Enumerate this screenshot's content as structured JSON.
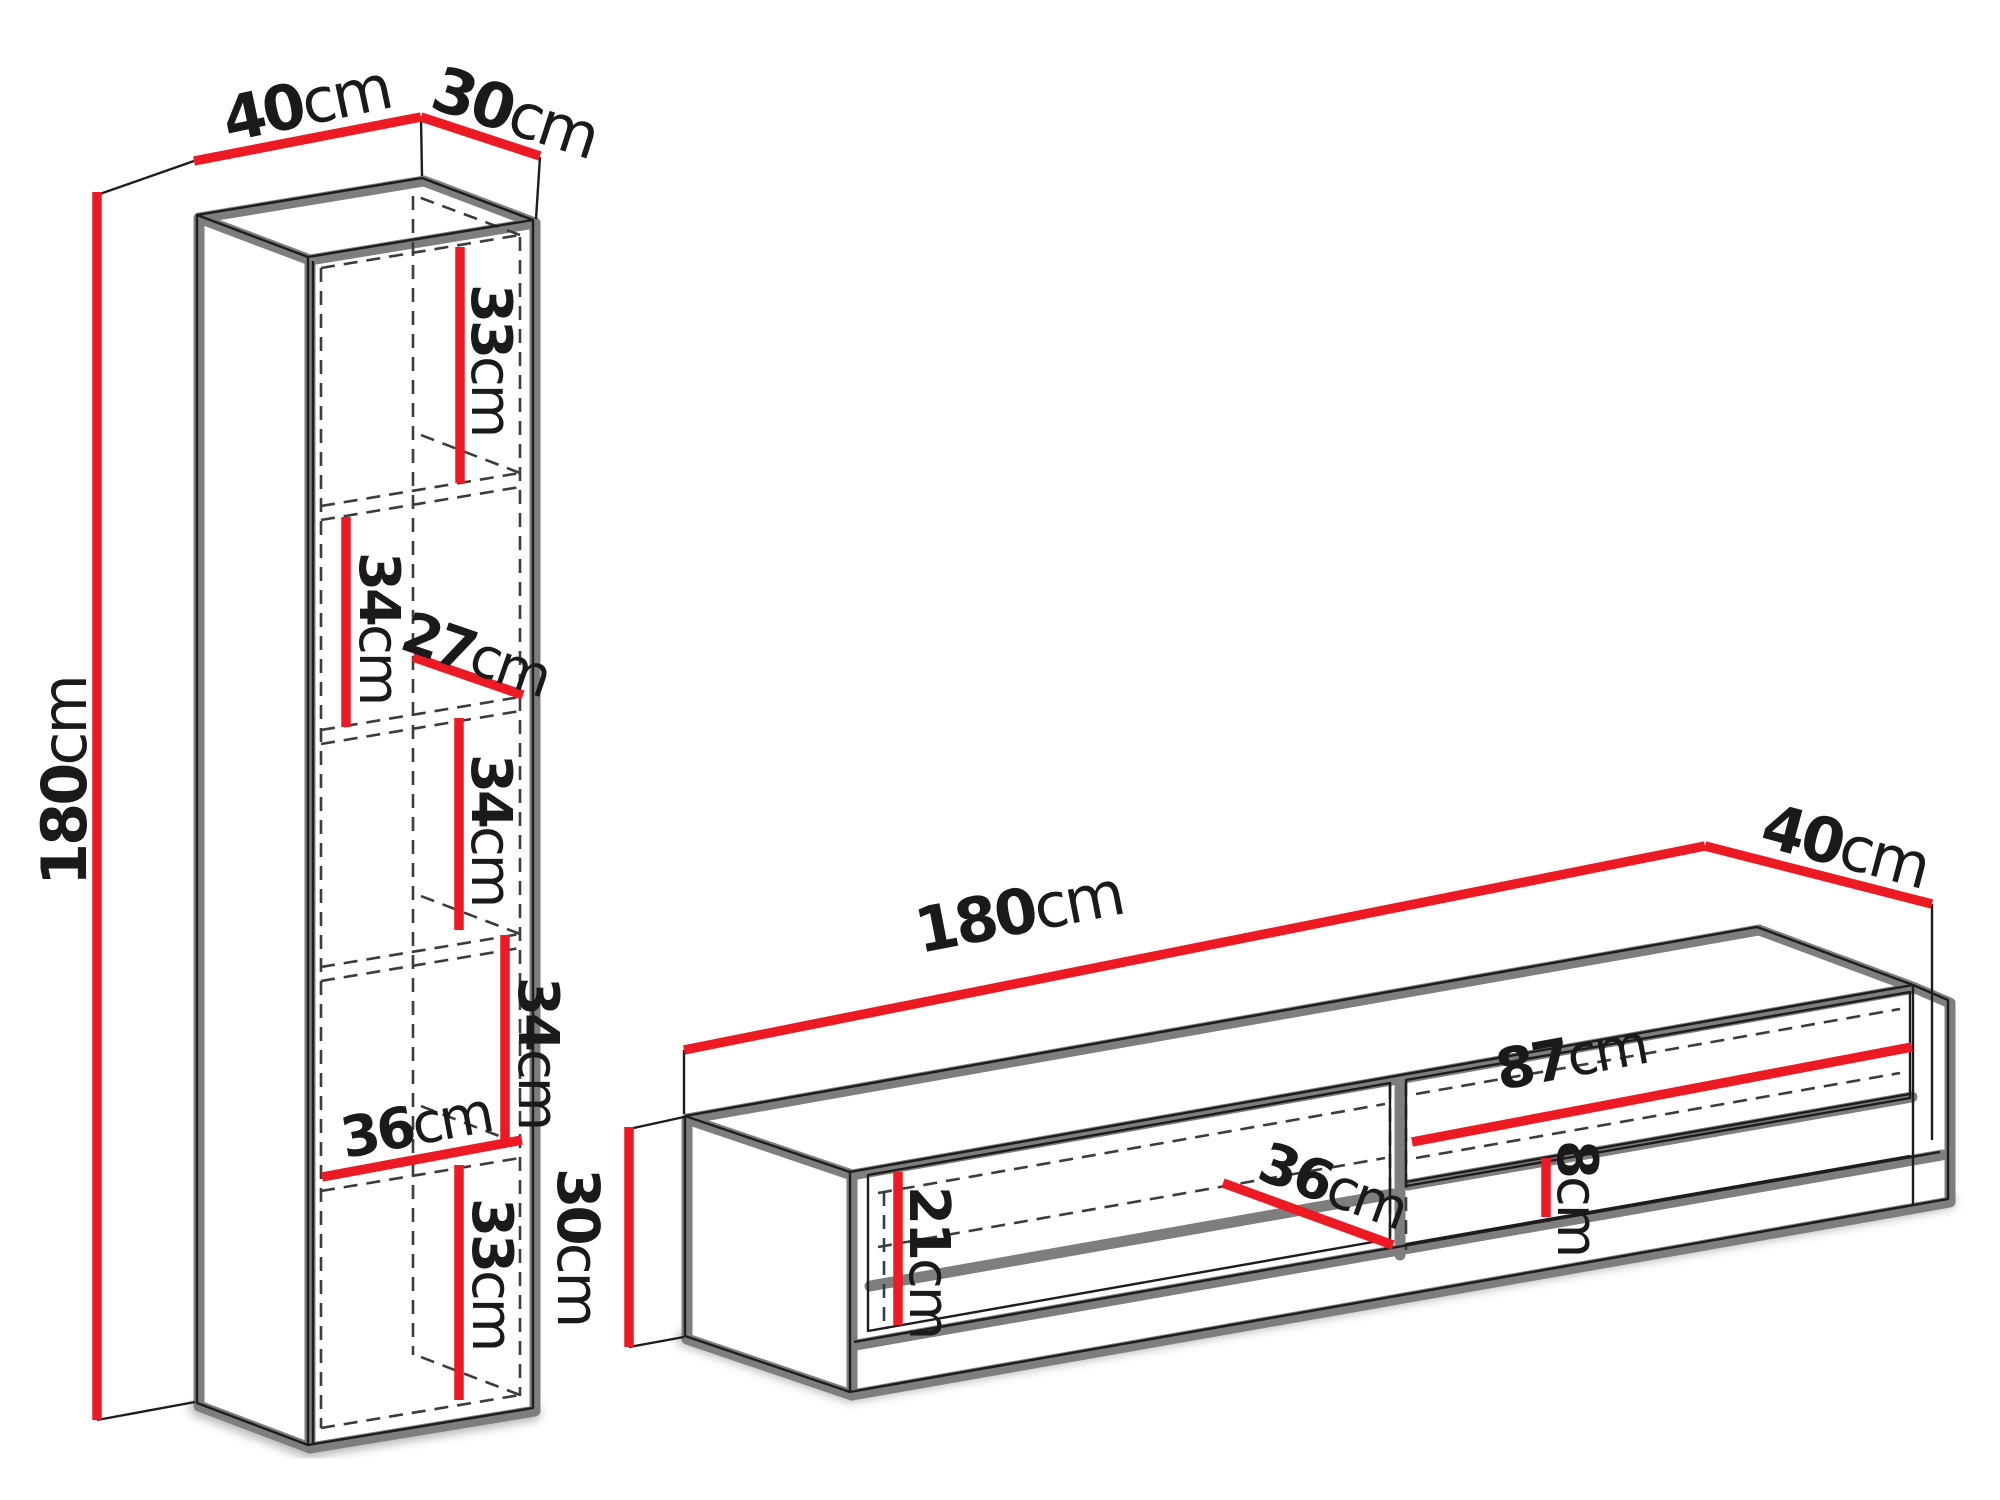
{
  "colors": {
    "dimension_red": "#ec1b23",
    "outline_gray": "#7e7e7e",
    "line_black": "#1d1d1d",
    "hidden_edge_gray": "#3c3c3c",
    "background": "#ffffff"
  },
  "cabinet": {
    "width": {
      "value": "40",
      "unit": "cm"
    },
    "depth": {
      "value": "30",
      "unit": "cm"
    },
    "height": {
      "value": "180",
      "unit": "cm"
    },
    "compartment_1": {
      "value": "33",
      "unit": "cm"
    },
    "compartment_2": {
      "value": "34",
      "unit": "cm"
    },
    "shelf_depth": {
      "value": "27",
      "unit": "cm"
    },
    "compartment_3": {
      "value": "34",
      "unit": "cm"
    },
    "compartment_4": {
      "value": "34",
      "unit": "cm"
    },
    "interior_width": {
      "value": "36",
      "unit": "cm"
    },
    "compartment_5": {
      "value": "33",
      "unit": "cm"
    }
  },
  "tv_stand": {
    "width": {
      "value": "180",
      "unit": "cm"
    },
    "depth": {
      "value": "40",
      "unit": "cm"
    },
    "height": {
      "value": "30",
      "unit": "cm"
    },
    "front_height": {
      "value": "21",
      "unit": "cm"
    },
    "interior_depth": {
      "value": "36",
      "unit": "cm"
    },
    "niche_width": {
      "value": "87",
      "unit": "cm"
    },
    "niche_height": {
      "value": "8",
      "unit": "cm"
    }
  }
}
